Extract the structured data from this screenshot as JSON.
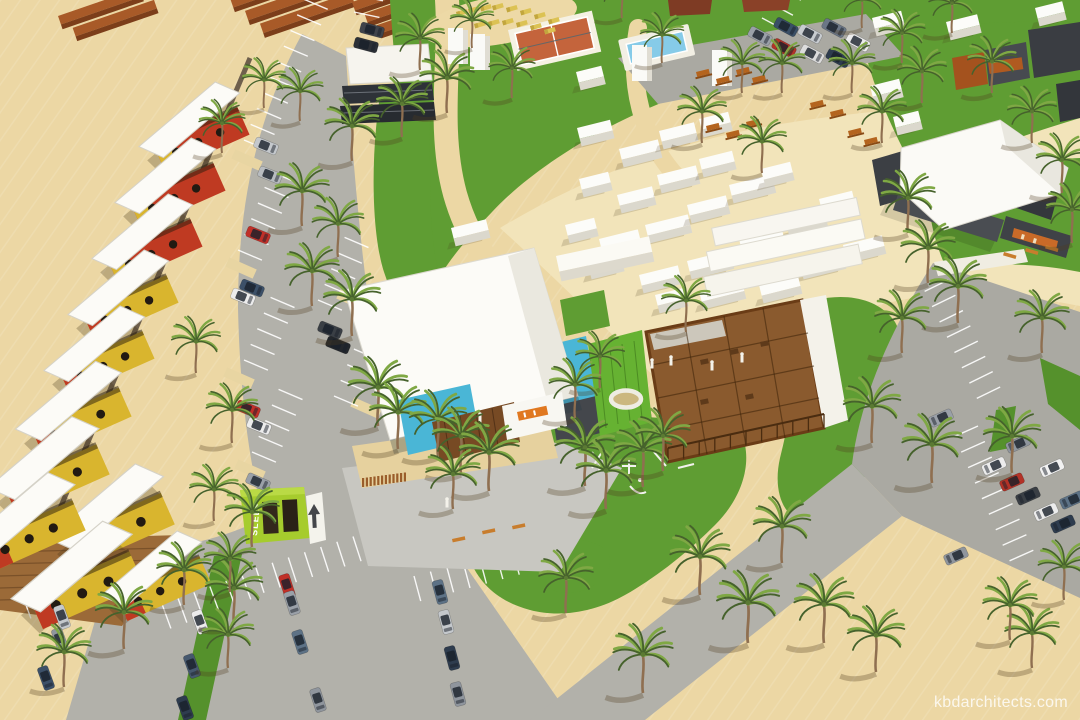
{
  "watermark": {
    "text": "kbdarchitects.com"
  },
  "signs": {
    "hostel_container_text": "SLEEP"
  },
  "palette": {
    "sand": "#ecd7a4",
    "sand_light": "#f2e4ba",
    "grass": "#5f9d33",
    "grass_dark": "#55912c",
    "road": "#b2b1aa",
    "parking": "#aaa9a2",
    "canopy_white": "#fcfbf7",
    "container_yellow": "#d9b52e",
    "container_red": "#bf3a22",
    "container_cyan": "#4ab6d6",
    "container_green": "#66b232",
    "container_lime": "#a6cc2d",
    "stage_yellow": "#ecc530",
    "wood_deck": "#8a5a2e",
    "brick": "#a85a28",
    "brick_dark": "#7c3e1a",
    "pool_water": "#86cbe8",
    "sports_court": "#c4643c",
    "asphalt_stripe": "#ffffff"
  },
  "scene": {
    "palms": [
      [
        420,
        70,
        0.9
      ],
      [
        447,
        113,
        1
      ],
      [
        402,
        137,
        0.95
      ],
      [
        352,
        161,
        1
      ],
      [
        302,
        226,
        1
      ],
      [
        338,
        257,
        0.95
      ],
      [
        312,
        306,
        1
      ],
      [
        352,
        336,
        1.05
      ],
      [
        378,
        426,
        1.1
      ],
      [
        398,
        449,
        1.05
      ],
      [
        300,
        121,
        0.85
      ],
      [
        264,
        108,
        0.8
      ],
      [
        222,
        153,
        0.85
      ],
      [
        196,
        373,
        0.9
      ],
      [
        232,
        443,
        0.95
      ],
      [
        214,
        521,
        0.9
      ],
      [
        252,
        547,
        1
      ],
      [
        234,
        625,
        1.05
      ],
      [
        184,
        605,
        1
      ],
      [
        124,
        649,
        1.05
      ],
      [
        64,
        687,
        1
      ],
      [
        438,
        456,
        1.05
      ],
      [
        461,
        473,
        1.05
      ],
      [
        489,
        491,
        1.1
      ],
      [
        453,
        509,
        1
      ],
      [
        585,
        486,
        1.1
      ],
      [
        606,
        509,
        1.1
      ],
      [
        643,
        487,
        1.05
      ],
      [
        663,
        471,
        1
      ],
      [
        700,
        595,
        1.1
      ],
      [
        748,
        643,
        1.15
      ],
      [
        824,
        643,
        1.1
      ],
      [
        782,
        563,
        1.05
      ],
      [
        643,
        693,
        1.1
      ],
      [
        566,
        613,
        1
      ],
      [
        908,
        233,
        1
      ],
      [
        928,
        283,
        1
      ],
      [
        958,
        323,
        1.05
      ],
      [
        902,
        353,
        1
      ],
      [
        872,
        443,
        1.05
      ],
      [
        932,
        483,
        1.1
      ],
      [
        1012,
        473,
        1.05
      ],
      [
        1042,
        353,
        1
      ],
      [
        1062,
        193,
        0.95
      ],
      [
        1032,
        143,
        0.9
      ],
      [
        992,
        93,
        0.9
      ],
      [
        952,
        33,
        0.85
      ],
      [
        922,
        103,
        0.9
      ],
      [
        882,
        143,
        0.9
      ],
      [
        852,
        93,
        0.85
      ],
      [
        902,
        63,
        0.85
      ],
      [
        862,
        28,
        0.8
      ],
      [
        782,
        93,
        0.85
      ],
      [
        742,
        93,
        0.85
      ],
      [
        702,
        143,
        0.9
      ],
      [
        762,
        173,
        0.9
      ],
      [
        662,
        63,
        0.8
      ],
      [
        622,
        18,
        0.8
      ],
      [
        472,
        48,
        0.8
      ],
      [
        512,
        98,
        0.85
      ],
      [
        1072,
        243,
        0.95
      ],
      [
        230,
        592,
        0.95
      ],
      [
        228,
        668,
        0.95
      ],
      [
        686,
        332,
        0.9
      ],
      [
        600,
        388,
        0.9
      ],
      [
        575,
        418,
        0.95
      ],
      [
        876,
        672,
        1.05
      ],
      [
        1032,
        668,
        1.0
      ],
      [
        1010,
        640,
        1.0
      ],
      [
        1064,
        600,
        0.95
      ]
    ],
    "cars": [
      [
        372,
        30,
        -75,
        "#3f434a"
      ],
      [
        366,
        45,
        -75,
        "#2c3036"
      ],
      [
        266,
        146,
        -68,
        "#c4c8cc"
      ],
      [
        270,
        175,
        -68,
        "#b8bcc0"
      ],
      [
        258,
        235,
        -68,
        "#c03028"
      ],
      [
        252,
        288,
        -68,
        "#3c5068"
      ],
      [
        243,
        297,
        -68,
        "#ececec"
      ],
      [
        330,
        330,
        -68,
        "#3a3f45"
      ],
      [
        338,
        345,
        -68,
        "#23272c"
      ],
      [
        248,
        409,
        -68,
        "#c03028"
      ],
      [
        259,
        426,
        -68,
        "#ececec"
      ],
      [
        258,
        482,
        -66,
        "#9aa0a8"
      ],
      [
        786,
        27,
        -62,
        "#3a4f66"
      ],
      [
        810,
        34,
        -62,
        "#c8ccd0"
      ],
      [
        834,
        28,
        -62,
        "#6b7686"
      ],
      [
        858,
        42,
        -62,
        "#ececec"
      ],
      [
        784,
        48,
        -62,
        "#b33227"
      ],
      [
        812,
        54,
        -62,
        "#dcdcdc"
      ],
      [
        838,
        58,
        -62,
        "#2e3c4e"
      ],
      [
        760,
        36,
        -62,
        "#9aa0a8"
      ],
      [
        62,
        617,
        -20,
        "#c4c8cc"
      ],
      [
        60,
        640,
        -20,
        "#8f959d"
      ],
      [
        46,
        678,
        -20,
        "#3c5068"
      ],
      [
        200,
        622,
        -20,
        "#ececec"
      ],
      [
        192,
        666,
        -20,
        "#46586e"
      ],
      [
        185,
        708,
        -20,
        "#2e3c4e"
      ],
      [
        287,
        586,
        -18,
        "#c03028"
      ],
      [
        292,
        603,
        -18,
        "#9aa0a8"
      ],
      [
        300,
        642,
        -18,
        "#5d7286"
      ],
      [
        318,
        700,
        -18,
        "#8f959d"
      ],
      [
        440,
        592,
        -15,
        "#5d7286"
      ],
      [
        446,
        622,
        -15,
        "#c4c8cc"
      ],
      [
        452,
        658,
        -15,
        "#2e3c4e"
      ],
      [
        458,
        694,
        -15,
        "#8f959d"
      ],
      [
        1018,
        444,
        66,
        "#8f959d"
      ],
      [
        994,
        466,
        66,
        "#ececec"
      ],
      [
        1052,
        468,
        66,
        "#f2f2f2"
      ],
      [
        1012,
        482,
        66,
        "#b33227"
      ],
      [
        1028,
        496,
        66,
        "#3a3f45"
      ],
      [
        1072,
        500,
        66,
        "#5d7286"
      ],
      [
        1046,
        512,
        66,
        "#ececec"
      ],
      [
        1063,
        524,
        66,
        "#2e3c4e"
      ],
      [
        941,
        418,
        66,
        "#9aa0a8"
      ],
      [
        956,
        556,
        66,
        "#8f959d"
      ]
    ],
    "white_boxes": [
      [
        577,
        128,
        34
      ],
      [
        619,
        149,
        40
      ],
      [
        659,
        131,
        36
      ],
      [
        699,
        119,
        30
      ],
      [
        579,
        179,
        30
      ],
      [
        617,
        195,
        36
      ],
      [
        657,
        175,
        40
      ],
      [
        699,
        159,
        34
      ],
      [
        565,
        225,
        30
      ],
      [
        599,
        239,
        40
      ],
      [
        645,
        225,
        44
      ],
      [
        687,
        205,
        40
      ],
      [
        729,
        185,
        44
      ],
      [
        761,
        169,
        30
      ],
      [
        639,
        275,
        40
      ],
      [
        687,
        261,
        44
      ],
      [
        739,
        239,
        44
      ],
      [
        785,
        219,
        40
      ],
      [
        819,
        199,
        34
      ],
      [
        843,
        245,
        40
      ],
      [
        799,
        261,
        44
      ],
      [
        759,
        285,
        40
      ],
      [
        699,
        291,
        44
      ],
      [
        655,
        295,
        30
      ],
      [
        587,
        261,
        34
      ],
      [
        451,
        228,
        36
      ],
      [
        872,
        18,
        30
      ],
      [
        946,
        22,
        32
      ],
      [
        870,
        86,
        30
      ],
      [
        893,
        117,
        26
      ],
      [
        576,
        72,
        26
      ],
      [
        1035,
        8,
        28
      ],
      [
        1065,
        40,
        26
      ]
    ],
    "housing_modules": [
      [
        228,
        96,
        1,
        "red"
      ],
      [
        204,
        152,
        1,
        "red"
      ],
      [
        181,
        208,
        1,
        "red"
      ],
      [
        157,
        264,
        1,
        "yellow"
      ],
      [
        133,
        320,
        1,
        "yellow"
      ],
      [
        109,
        376,
        1.05,
        "yellow"
      ],
      [
        86,
        432,
        1.1,
        "yellow"
      ],
      [
        150,
        480,
        1.15,
        "yellow"
      ],
      [
        118,
        538,
        1.2,
        "yellow"
      ],
      [
        62,
        488,
        1.1,
        "yellow"
      ],
      [
        190,
        545,
        1,
        "yellow"
      ]
    ],
    "stripe_groups": [
      [
        244,
        140,
        10,
        -67
      ],
      [
        238,
        250,
        6,
        -67
      ],
      [
        244,
        360,
        5,
        -67
      ],
      [
        252,
        452,
        5,
        -67
      ],
      [
        318,
        300,
        5,
        -67
      ],
      [
        334,
        396,
        4,
        -67
      ],
      [
        354,
        12,
        4,
        -78
      ],
      [
        22,
        594,
        6,
        -20
      ],
      [
        162,
        604,
        6,
        -20
      ],
      [
        256,
        568,
        7,
        -18
      ],
      [
        414,
        576,
        7,
        -15
      ],
      [
        948,
        280,
        8,
        64
      ],
      [
        978,
        426,
        9,
        66
      ],
      [
        762,
        18,
        9,
        -62
      ]
    ],
    "loungers": [
      [
        456,
        12
      ],
      [
        468,
        9
      ],
      [
        480,
        7
      ],
      [
        492,
        6
      ],
      [
        506,
        8
      ],
      [
        520,
        11
      ],
      [
        534,
        15
      ],
      [
        548,
        20
      ],
      [
        474,
        24
      ],
      [
        488,
        22
      ],
      [
        502,
        21
      ],
      [
        516,
        23
      ],
      [
        530,
        26
      ],
      [
        544,
        30
      ]
    ],
    "picnic_tables": [
      [
        696,
        72
      ],
      [
        716,
        79
      ],
      [
        736,
        70
      ],
      [
        752,
        78
      ],
      [
        706,
        126
      ],
      [
        726,
        133
      ],
      [
        746,
        122
      ],
      [
        810,
        103
      ],
      [
        830,
        112
      ],
      [
        848,
        131
      ],
      [
        864,
        140
      ]
    ],
    "benches": [
      [
        482,
        531,
        -12
      ],
      [
        512,
        526,
        -12
      ],
      [
        452,
        539,
        -12
      ],
      [
        1004,
        252,
        16
      ],
      [
        1026,
        248,
        16
      ],
      [
        1046,
        245,
        16
      ]
    ],
    "people": [
      [
        447,
        505
      ],
      [
        652,
        366
      ],
      [
        671,
        363
      ],
      [
        480,
        420
      ],
      [
        712,
        368
      ],
      [
        742,
        360
      ]
    ],
    "pillars": [
      [
        448,
        28
      ],
      [
        470,
        34
      ],
      [
        632,
        45
      ],
      [
        712,
        50
      ]
    ]
  }
}
